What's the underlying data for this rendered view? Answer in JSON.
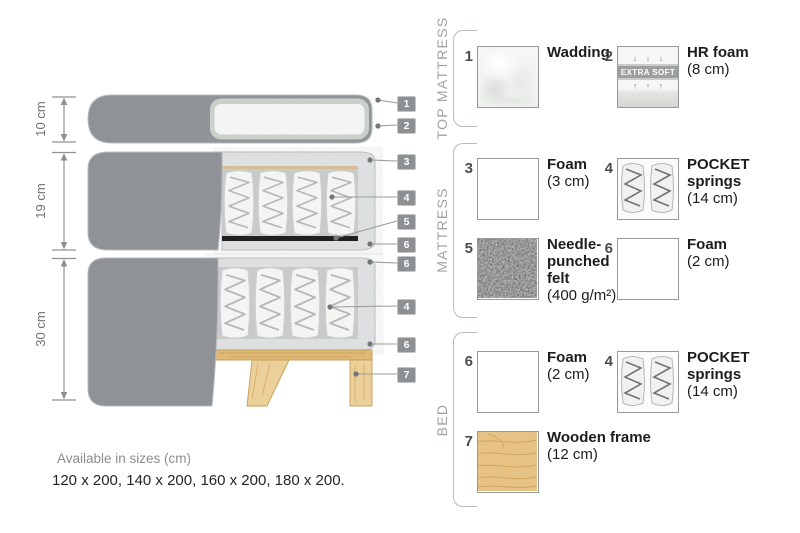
{
  "colors": {
    "fabric_gray": "#8f9296",
    "foam_speckle": "#e3e5e6",
    "wood": "#e6c285",
    "felt": "#555755",
    "tag_bg": "#8d9092",
    "text_dark": "#1d1d1d",
    "text_gray": "#9fa2a3"
  },
  "diagram": {
    "dimensions": [
      {
        "label": "10 cm"
      },
      {
        "label": "19 cm"
      },
      {
        "label": "30 cm"
      }
    ],
    "markers": [
      "1",
      "2",
      "3",
      "4",
      "5",
      "6",
      "6",
      "4",
      "6",
      "7"
    ]
  },
  "legend": {
    "sections": [
      {
        "title": "TOP MATTRESS",
        "items": [
          {
            "number": "1",
            "name": "Wadding",
            "size": ""
          },
          {
            "number": "2",
            "name": "HR foam",
            "size": "(8 cm)",
            "badge": "EXTRA SOFT",
            "arrows_down": "↓ ↓ ↓",
            "arrows_up": "↑ ↑ ↑"
          }
        ]
      },
      {
        "title": "MATTRESS",
        "items": [
          {
            "number": "3",
            "name": "Foam",
            "size": "(3 cm)"
          },
          {
            "number": "4",
            "name": "POCKET\nsprings",
            "size": "(14 cm)"
          },
          {
            "number": "5",
            "name": "Needle-\npunched\nfelt",
            "size": "(400 g/m²)"
          },
          {
            "number": "6",
            "name": "Foam",
            "size": "(2 cm)"
          }
        ]
      },
      {
        "title": "BED",
        "items": [
          {
            "number": "6",
            "name": "Foam",
            "size": "(2 cm)"
          },
          {
            "number": "4",
            "name": "POCKET\nsprings",
            "size": "(14 cm)"
          },
          {
            "number": "7",
            "name": "Wooden frame",
            "size": "(12 cm)"
          }
        ]
      }
    ]
  },
  "footer": {
    "title": "Available in sizes (cm)",
    "values": "120 x 200, 140 x 200, 160 x 200, 180 x 200."
  }
}
